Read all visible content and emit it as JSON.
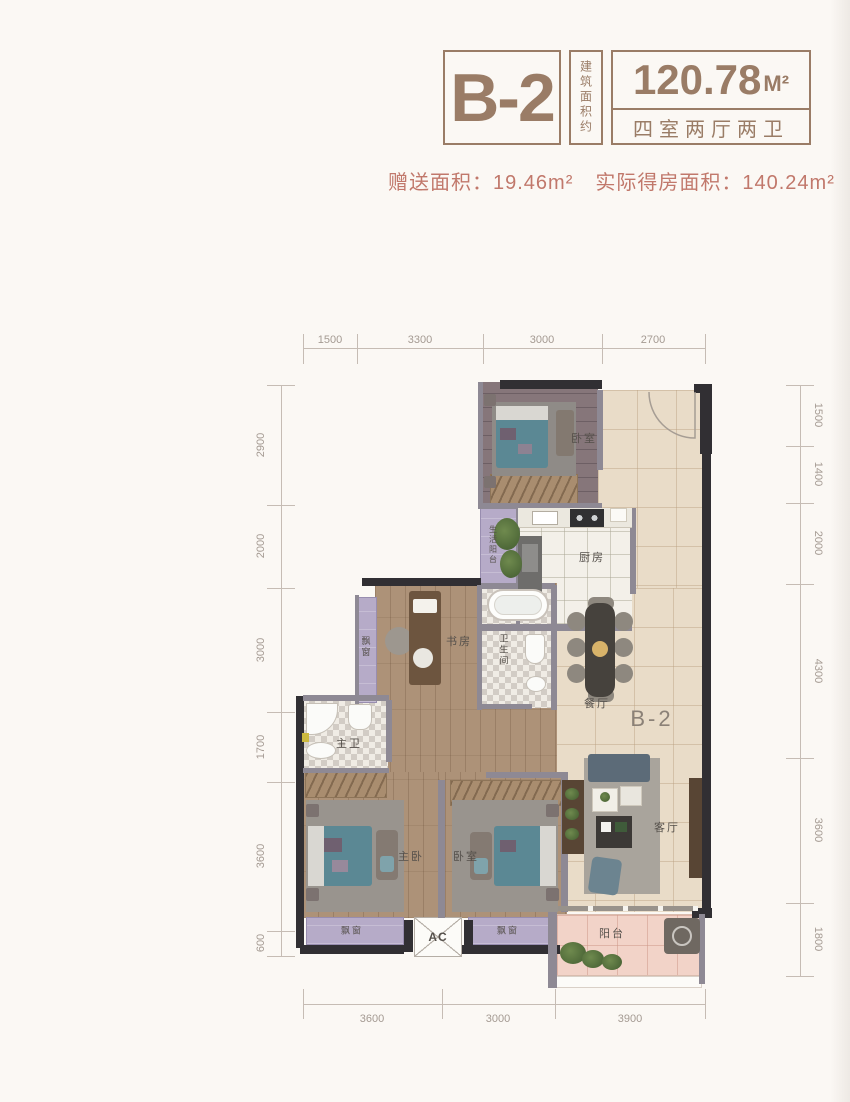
{
  "header": {
    "unit": "B-2",
    "area_note": "建筑面积约",
    "area_value": "120.78",
    "area_unit": "M²",
    "rooms_desc": "四室两厅两卫",
    "gift_label": "赠送面积：",
    "gift_value": "19.46m²",
    "actual_label": "实际得房面积：",
    "actual_value": "140.24m²"
  },
  "plan": {
    "watermark": "B-2",
    "labels": {
      "bedroom_top": "卧室",
      "service_balcony": "生活阳台",
      "kitchen": "厨房",
      "study": "书房",
      "bathroom": "卫生间",
      "dining": "餐厅",
      "master_bath": "主卫",
      "master_bedroom": "主卧",
      "second_bedroom": "卧室",
      "living_room": "客厅",
      "balcony": "阳台",
      "bay_window_study": "飘窗",
      "bay_window_master": "飘窗",
      "bay_window_second": "飘窗",
      "ac": "AC"
    },
    "dimensions": {
      "top": [
        "1500",
        "3300",
        "3000",
        "2700"
      ],
      "bottom": [
        "3600",
        "3000",
        "3900"
      ],
      "left": [
        "2900",
        "2000",
        "3000",
        "1700",
        "3600",
        "600"
      ],
      "right": [
        "1500",
        "1400",
        "2000",
        "4300",
        "3600",
        "1800"
      ]
    }
  },
  "colors": {
    "brand_brown": "#9a7c66",
    "accent_red": "#c1786b",
    "wall_dark": "#312f33",
    "wall_gray": "#8e8994",
    "tile_beige": "#e9dcc8",
    "bay_purple": "#b6abc8",
    "balcony_pink": "#f2d3c8",
    "bed_teal": "#5b8894"
  }
}
